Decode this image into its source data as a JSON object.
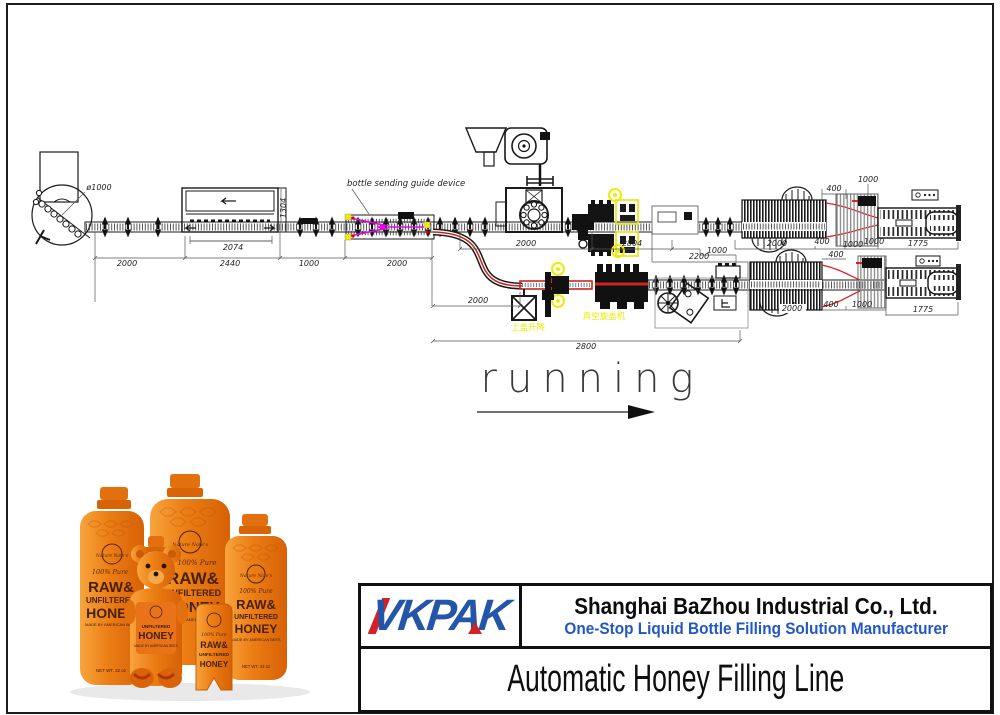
{
  "colors": {
    "logo_blue": "#2356a8",
    "logo_red": "#d32127",
    "tagline_blue": "#2257c4",
    "guide_magenta": "#ee00ee",
    "highlight_yellow": "#f0ec00",
    "conveyor_red": "#cc2222",
    "honey_orange": "#e87c1b"
  },
  "diagram": {
    "dims": [
      "2000",
      "2440",
      "1000",
      "2000",
      "2074",
      "1304",
      "ø1000",
      "2000",
      "2804",
      "2000",
      "400",
      "1000",
      "1000",
      "1775",
      "400",
      "1000",
      "2200",
      "1000",
      "400",
      "2000",
      "2800",
      "2000",
      "400",
      "1000",
      "1775"
    ],
    "labels": {
      "guide_device": "bottle sending guide device",
      "vacuum_capper": "真空旋盖机",
      "cap_feeder": "上盖升降"
    },
    "running_label": "running"
  },
  "title_block": {
    "logo_text": "VKPAK",
    "company_name": "Shanghai BaZhou Industrial Co., Ltd.",
    "tagline": "One-Stop Liquid Bottle Filling Solution Manufacturer",
    "product_title": "Automatic Honey Filling Line"
  },
  "product_photo": {
    "brand": "Nature Nate's",
    "pure": "100% Pure",
    "raw": "RAW&",
    "unfiltered": "UNFILTERED",
    "honey": "HONEY",
    "made_by": "MADE BY AMERICAN BEES",
    "net_wt": "NET WT. 32 oz"
  }
}
